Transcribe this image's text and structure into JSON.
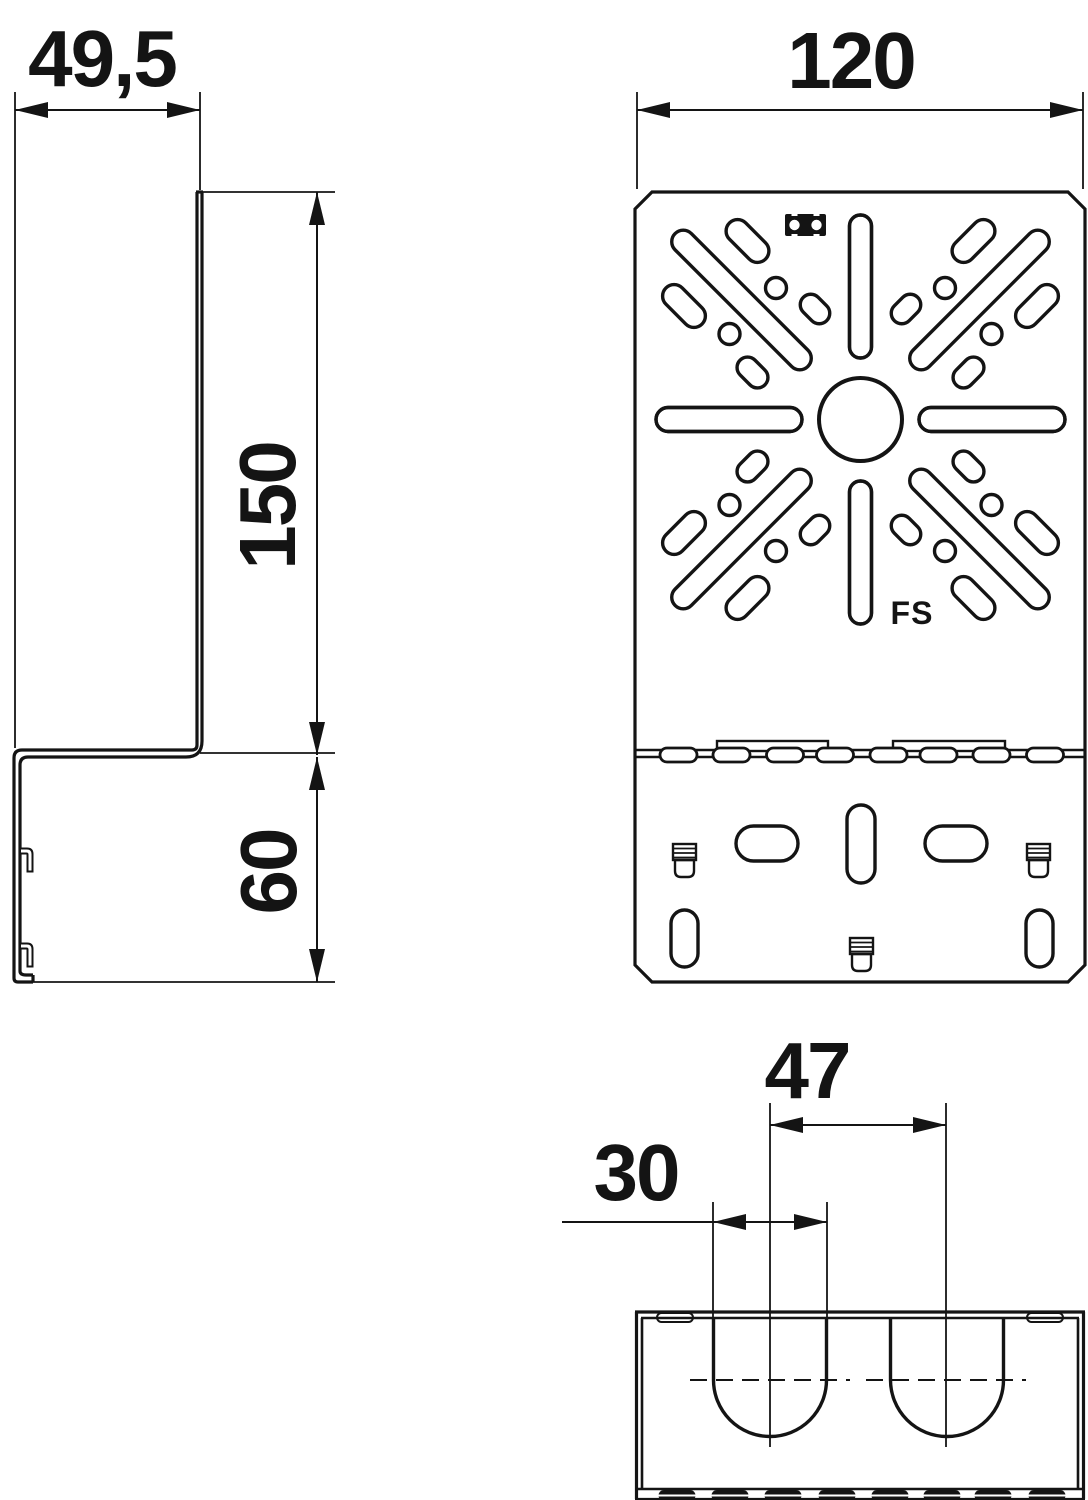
{
  "drawing": {
    "background": "#ffffff",
    "line_color": "#141414",
    "views": {
      "side": {
        "title": "side profile view",
        "dims": {
          "depth": "49,5",
          "upper_height": "150",
          "lower_height": "60"
        }
      },
      "front": {
        "title": "front view",
        "dims": {
          "width": "120"
        },
        "part_marking": "FS"
      },
      "detail": {
        "title": "bottom detail view",
        "dims": {
          "slot_spacing": "47",
          "slot_width": "30"
        }
      }
    }
  }
}
